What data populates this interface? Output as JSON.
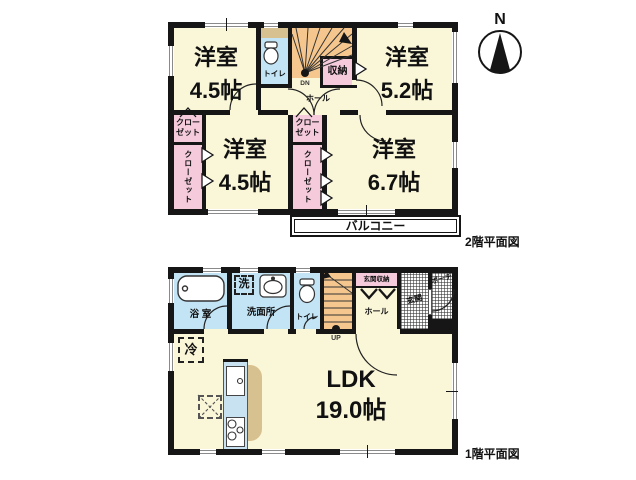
{
  "compass": "N",
  "floor2": {
    "caption": "2階平面図",
    "room_tl": {
      "name": "洋室",
      "size": "4.5帖"
    },
    "room_tr": {
      "name": "洋室",
      "size": "5.2帖"
    },
    "room_bl": {
      "name": "洋室",
      "size": "4.5帖"
    },
    "room_br": {
      "name": "洋室",
      "size": "6.7帖"
    },
    "toilet": "トイレ",
    "storage": "収納",
    "hall": "ホール",
    "stairs_label": "DN",
    "closet_l1": "クロー",
    "closet_l2": "ゼット",
    "closet_full": "クローゼット",
    "balcony": "バルコニー"
  },
  "floor1": {
    "caption": "1階平面図",
    "bath": "浴 室",
    "laundry": "洗",
    "washroom": "洗面所",
    "toilet": "トイレ",
    "stairs_label": "UP",
    "entrance_storage": "玄関収納",
    "hall": "ホール",
    "entrance": "玄関",
    "porch": "ポーチ",
    "refrigerator": "冷",
    "ldk": "LDK",
    "ldk_size": "19.0帖"
  },
  "colors": {
    "room_fill": "#faf6d8",
    "closet_fill": "#f5cbdc",
    "wet_area_fill": "#c2e4f5",
    "stairs_fill": "#f5c78e",
    "counter_accent": "#d8c190",
    "wall": "#161616"
  }
}
